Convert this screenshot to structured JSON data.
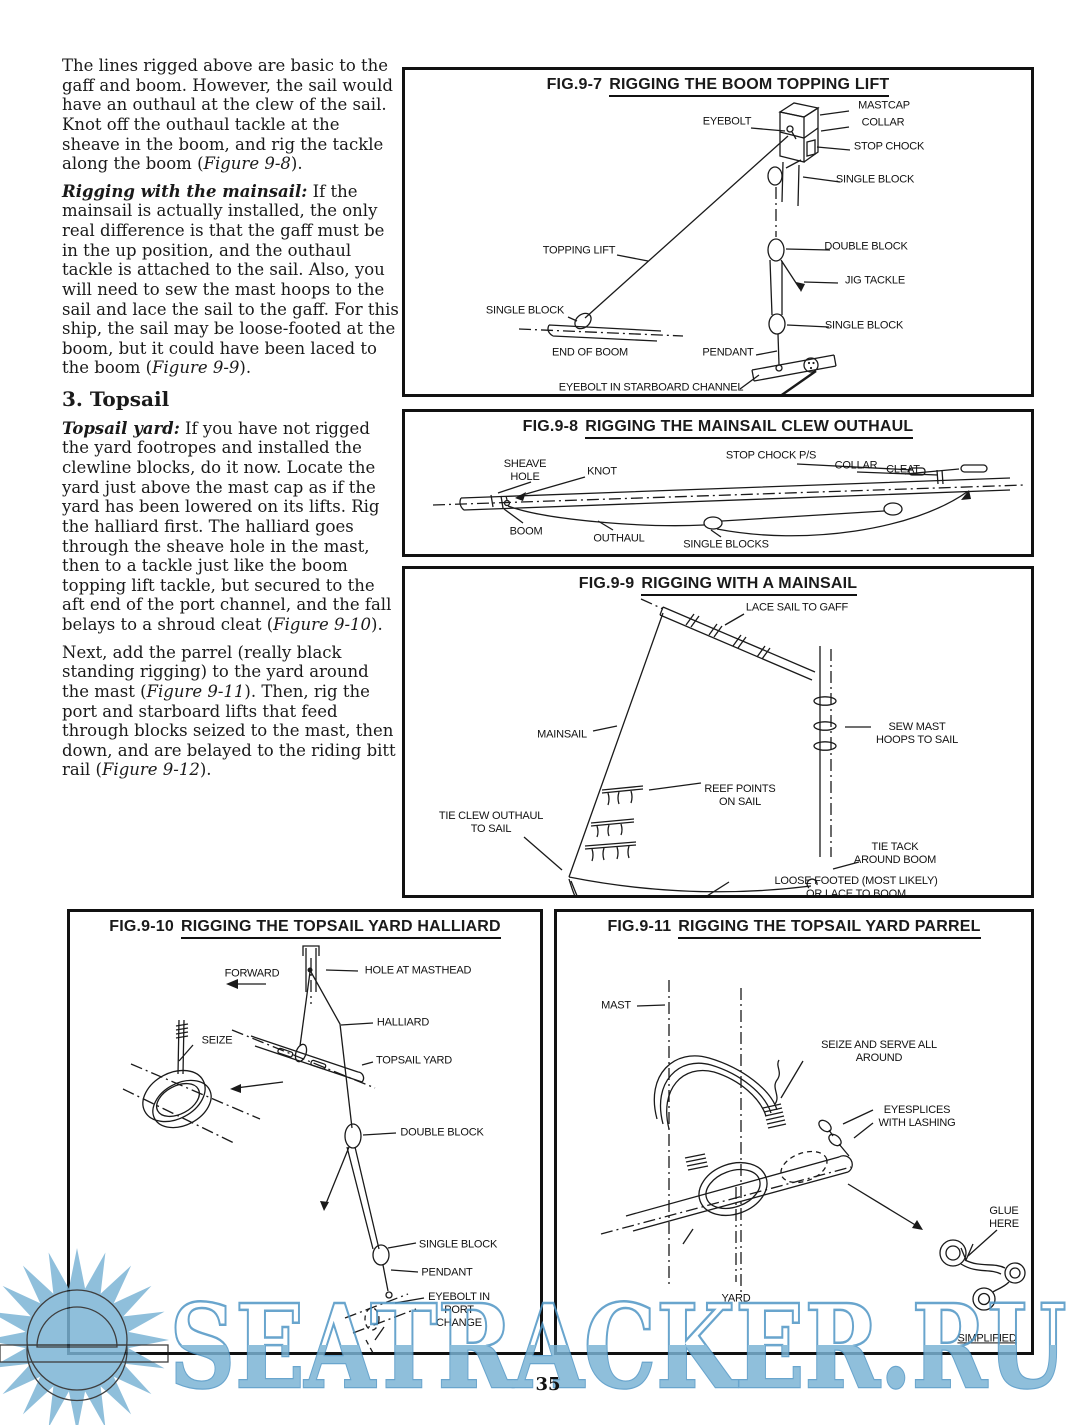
{
  "page": {
    "number": "35"
  },
  "article": {
    "p1": {
      "pre": "The lines rigged above are basic to the gaff and boom. However, the sail would have an outhaul at the clew of the sail. Knot off the outhaul tackle at the sheave in the boom, and rig the tackle along the boom (",
      "fig": "Figure 9-8",
      "post": ")."
    },
    "p2": {
      "lead": "Rigging with the mainsail:",
      "body": " If the mainsail is actually installed, the only real difference is that the gaff must be in the up position, and the outhaul tackle is attached to the sail. Also, you will need to sew the mast hoops to the sail and lace the sail to the gaff. For this ship, the sail may be loose-footed at the boom, but it could have been laced to the boom (",
      "fig": "Figure 9-9",
      "post": ")."
    },
    "heading": "3. Topsail",
    "p3": {
      "lead": "Topsail yard:",
      "body": " If you have not rigged the yard footropes and installed the clewline blocks, do it now. Locate the yard just above the mast cap as if the yard has been lowered on its lifts. Rig the halliard first. The halliard goes through the sheave hole in the mast, then to a tackle just like the boom topping lift tackle, but secured to the aft end of the port channel, and the fall belays to a shroud cleat (",
      "fig": "Figure 9-10",
      "post": ")."
    },
    "p4": {
      "pre": "Next, add the parrel (really black standing rigging) to the yard around the mast (",
      "fig1": "Figure 9-11",
      "mid": "). Then, rig the port and starboard lifts that feed through blocks seized to the mast, then down, and are belayed to the riding bitt rail (",
      "fig2": "Figure 9-12",
      "post": ")."
    }
  },
  "fig97": {
    "code": "FIG.9-7",
    "title": "RIGGING THE BOOM TOPPING LIFT",
    "labels": {
      "eyebolt": "EYEBOLT",
      "mastcap": "MASTCAP",
      "collar": "COLLAR",
      "stop_chock": "STOP CHOCK",
      "single_block_top": "SINGLE BLOCK",
      "topping_lift": "TOPPING LIFT",
      "double_block": "DOUBLE BLOCK",
      "jig_tackle": "JIG TACKLE",
      "single_block_left": "SINGLE BLOCK",
      "single_block_right": "SINGLE BLOCK",
      "end_of_boom": "END OF BOOM",
      "pendant": "PENDANT",
      "eyebolt_channel": "EYEBOLT IN STARBOARD CHANNEL"
    }
  },
  "fig98": {
    "code": "FIG.9-8",
    "title": "RIGGING THE MAINSAIL CLEW OUTHAUL",
    "labels": {
      "sheave_hole": "SHEAVE\nHOLE",
      "knot": "KNOT",
      "stop_chock": "STOP CHOCK P/S",
      "collar": "COLLAR",
      "cleat": "CLEAT",
      "boom": "BOOM",
      "outhaul": "OUTHAUL",
      "single_blocks": "SINGLE BLOCKS"
    }
  },
  "fig99": {
    "code": "FIG.9-9",
    "title": "RIGGING WITH A MAINSAIL",
    "labels": {
      "lace": "LACE SAIL TO GAFF",
      "mainsail": "MAINSAIL",
      "sew": "SEW MAST\nHOOPS TO SAIL",
      "reef": "REEF POINTS\nON SAIL",
      "tie_clew": "TIE CLEW OUTHAUL\nTO SAIL",
      "tie_tack": "TIE TACK\nAROUND BOOM",
      "loose": "LOOSE FOOTED (MOST LIKELY) OR LACE TO BOOM"
    }
  },
  "fig910": {
    "code": "FIG.9-10",
    "title": "RIGGING THE TOPSAIL YARD HALLIARD",
    "labels": {
      "forward": "FORWARD",
      "hole": "HOLE AT MASTHEAD",
      "seize": "SEIZE",
      "halliard": "HALLIARD",
      "topsail_yard": "TOPSAIL YARD",
      "double_block": "DOUBLE BLOCK",
      "single_block": "SINGLE BLOCK",
      "pendant": "PENDANT",
      "eyebolt": "EYEBOLT IN\nPORT\nCHANGE"
    }
  },
  "fig911": {
    "code": "FIG.9-11",
    "title": "RIGGING THE TOPSAIL YARD PARREL",
    "labels": {
      "mast": "MAST",
      "seize_serve": "SEIZE AND SERVE ALL AROUND",
      "eyesplices": "EYESPLICES\nWITH LASHING",
      "glue": "GLUE\nHERE",
      "yard": "YARD",
      "simplified": "SIMPLIFIED"
    }
  },
  "watermark": {
    "text": "SEATRACKER.RU",
    "fill": "#7ab3d5",
    "stroke": "#4d94c4"
  }
}
